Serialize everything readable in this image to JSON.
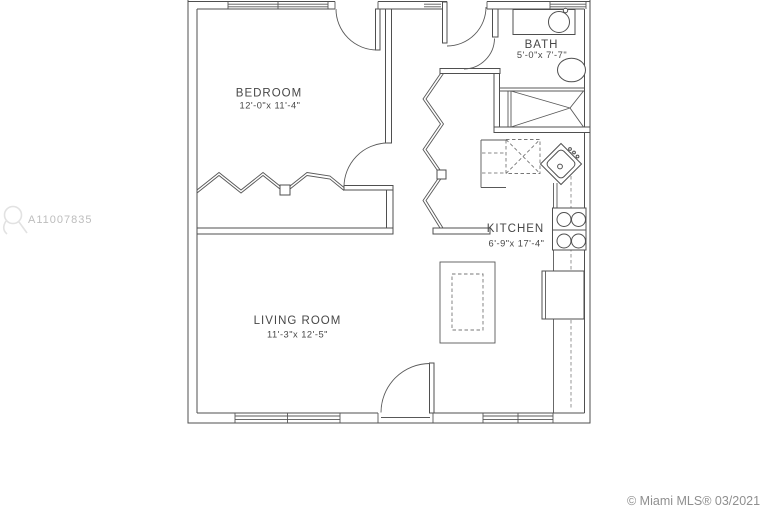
{
  "colors": {
    "background": "#ffffff",
    "linework": "#4f4f4f",
    "watermark_text": "#bdbdbd",
    "copyright_text": "#8f8f8f"
  },
  "watermark": {
    "listing_id": "A11007835"
  },
  "footer": {
    "copyright": "© Miami MLS® 03/2021"
  },
  "floorplan": {
    "rooms": [
      {
        "name": "BEDROOM",
        "dimensions": "12'-0\"x 11'-4\""
      },
      {
        "name": "BATH",
        "dimensions": "5'-0\"x 7'-7\""
      },
      {
        "name": "KITCHEN",
        "dimensions": "6'-9\"x 17'-4\""
      },
      {
        "name": "LIVING ROOM",
        "dimensions": "11'-3\"x 12'-5\""
      }
    ],
    "fixtures": [
      "bathroom-sink",
      "toilet",
      "bathtub-shower",
      "kitchen-corner-sink",
      "stove",
      "refrigerator",
      "kitchen-island",
      "bedroom-closet-accordion-doors",
      "hall-closet-accordion-doors"
    ]
  }
}
